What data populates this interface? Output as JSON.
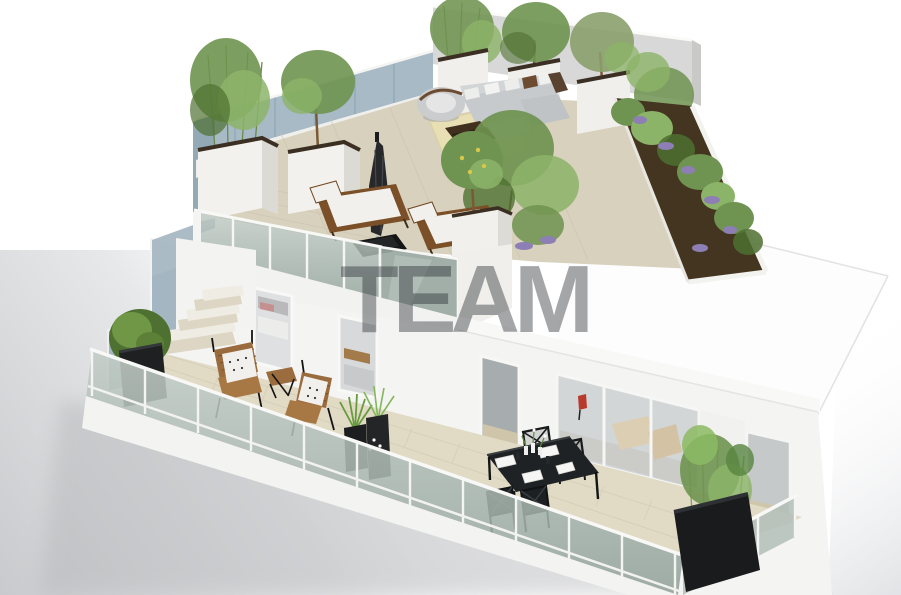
{
  "watermark": {
    "text": "TEAM"
  },
  "palette": {
    "bg": "#ffffff",
    "bgShadow": "#cdced1",
    "wallWhite": "#f4f4f3",
    "wallShade": "#d8d8d8",
    "wallSide": "#e6e6e4",
    "panelBlue": "#a7bac5",
    "panelBlueDark": "#93a9b6",
    "glass": "#b2beb8",
    "glassDark": "#99a8a1",
    "railWhite": "#f7f7f5",
    "floorTerrace": "#d8d1bd",
    "rug": "#e9dfb4",
    "floorBalcony": "#e1dac5",
    "tileLine": "#c6bfa9",
    "soil": "#43351f",
    "foliage": "#6f9350",
    "foliageLight": "#8cb468",
    "foliageDark": "#4e7030",
    "lavender": "#8d7fb5",
    "wood": "#8a5a33",
    "woodDark": "#6e451f",
    "sofa": "#c7cacc",
    "cushionWhite": "#f1f0ec",
    "charcoal": "#1f2224",
    "umbrella": "#26282a",
    "accentRed": "#b8392e",
    "lemon": "#d8c84a"
  }
}
